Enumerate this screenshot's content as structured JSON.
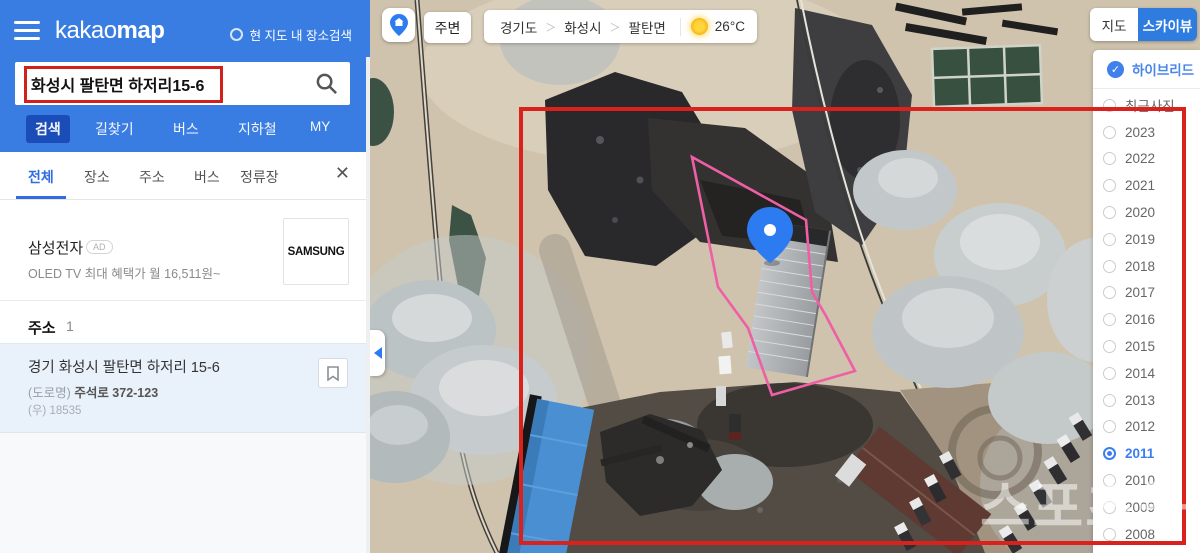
{
  "sidebar": {
    "logo": {
      "kakao": "kakao",
      "map": "map"
    },
    "scope_label": "현 지도 내 장소검색",
    "search": {
      "value": "화성시 팔탄면 하저리15-6"
    },
    "tabs": [
      "검색",
      "길찾기",
      "버스",
      "지하철",
      "MY"
    ],
    "filter_tabs": [
      "전체",
      "장소",
      "주소",
      "버스",
      "정류장"
    ],
    "ad": {
      "title": "삼성전자",
      "badge": "AD",
      "desc": "OLED TV 최대 혜택가 월 16,511원~",
      "brand": "SAMSUNG"
    },
    "section": {
      "title": "주소",
      "count": "1"
    },
    "result": {
      "title": "경기 화성시 팔탄면 하저리 15-6",
      "road_label": "(도로명)",
      "road_value": "주석로 372-123",
      "zip_label": "(우)",
      "zip_value": "18535"
    }
  },
  "map_bar": {
    "nearby": "주변",
    "breadcrumb": [
      "경기도",
      "화성시",
      "팔탄면"
    ],
    "separator": "＞",
    "temperature": "26°C"
  },
  "right_panel": {
    "map_label": "지도",
    "skyview_label": "스카이뷰",
    "hybrid_label": "하이브리드",
    "years": [
      "최근사진",
      "2023",
      "2022",
      "2021",
      "2020",
      "2019",
      "2018",
      "2017",
      "2016",
      "2015",
      "2014",
      "2013",
      "2012",
      "2011",
      "2010",
      "2009",
      "2008"
    ],
    "selected_year": "2011"
  },
  "icons": {
    "close": "✕",
    "check": "✓"
  },
  "watermark": "스포츠동아",
  "colors": {
    "header_blue": "#3a7de2",
    "active_tab_blue": "#1b4db8",
    "accent_blue": "#2f6de0",
    "skyview_blue": "#2e7ce0",
    "annotation_red": "#da211b",
    "parcel_pink": "#ee5fa6",
    "result_bg": "#e9f1fb"
  }
}
